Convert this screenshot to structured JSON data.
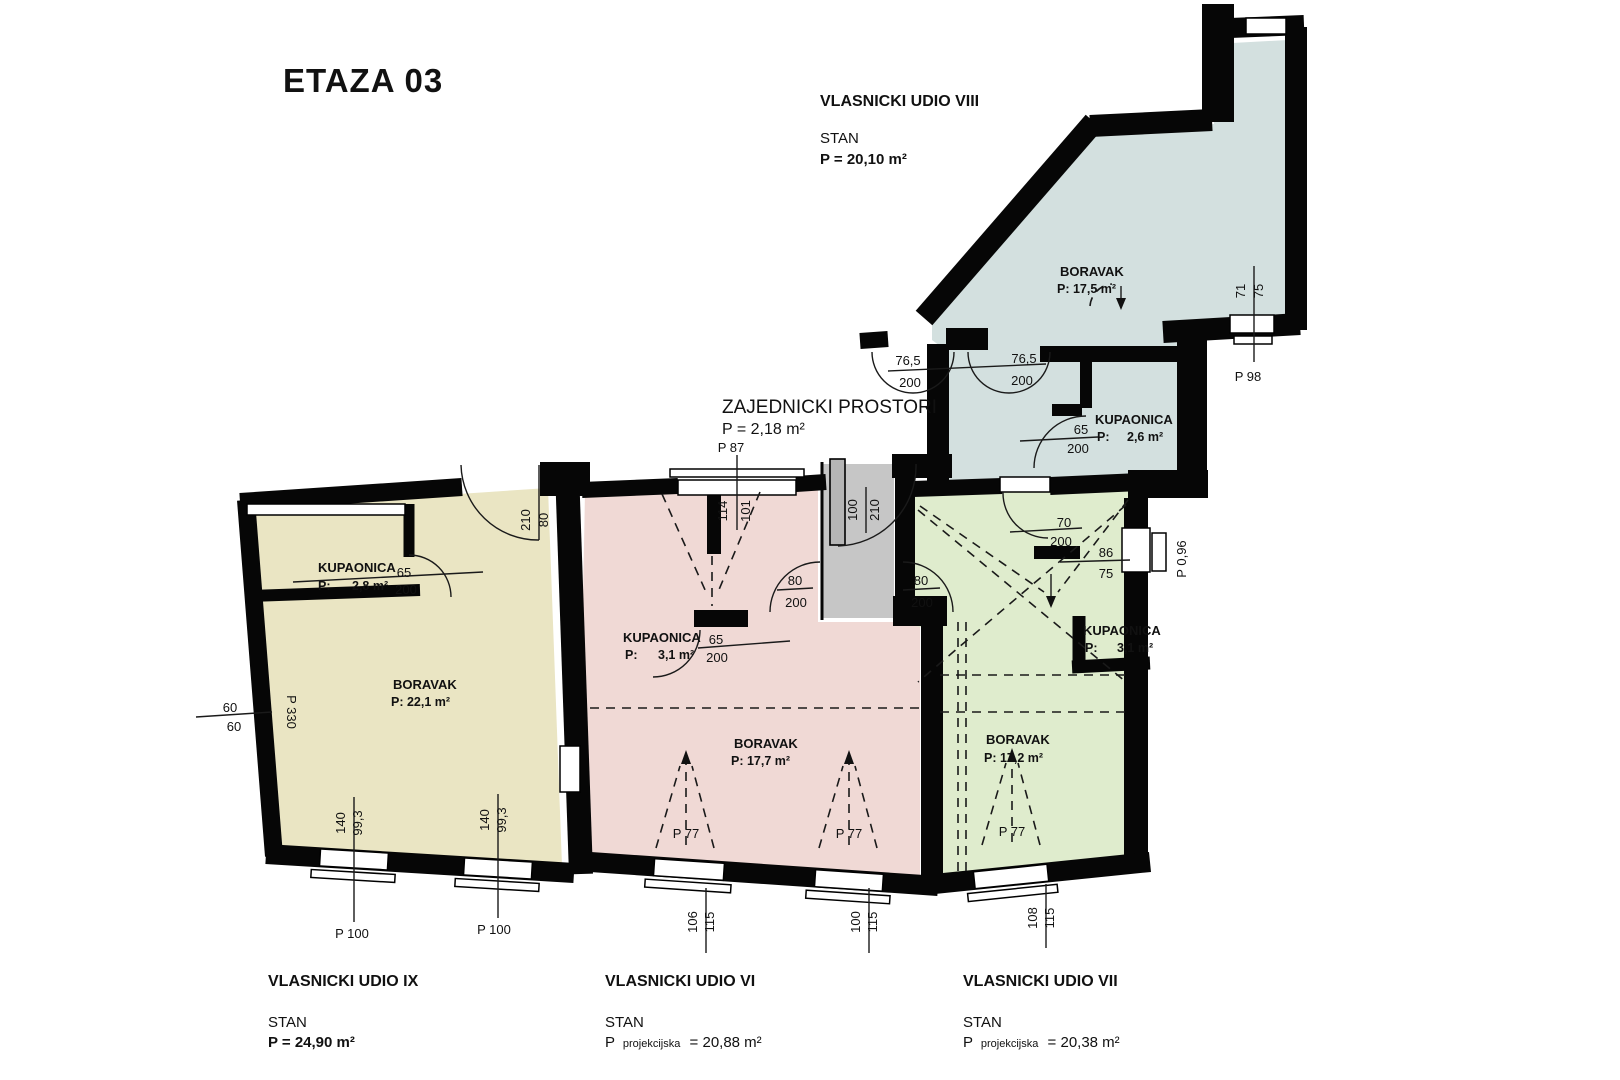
{
  "title": "ETAZA 03",
  "colors": {
    "unit_viii": "#d3e0df",
    "unit_ix": "#eae5c3",
    "unit_vi": "#f0d9d5",
    "unit_vii": "#dfeccd",
    "corridor": "#c6c6c6",
    "door_leaf": "#b5b5b5",
    "wall": "#060606"
  },
  "common_area": {
    "name": "ZAJEDNICKI PROSTORI",
    "area": "P = 2,18 m²"
  },
  "units": {
    "viii": {
      "title": "VLASNICKI UDIO VIII",
      "type": "STAN",
      "area": "P = 20,10 m²",
      "boravak": {
        "name": "BORAVAK",
        "area": "P: 17,5 m²"
      },
      "kupaonica": {
        "name": "KUPAONICA",
        "p": "P:",
        "value": "2,6 m²"
      }
    },
    "ix": {
      "title": "VLASNICKI UDIO IX",
      "type": "STAN",
      "area": "P = 24,90 m²",
      "boravak": {
        "name": "BORAVAK",
        "area": "P: 22,1 m²"
      },
      "kupaonica": {
        "name": "KUPAONICA",
        "p": "P:",
        "value": "2,8 m²"
      }
    },
    "vi": {
      "title": "VLASNICKI UDIO VI",
      "type": "STAN",
      "p": "P",
      "p_sub": "projekcijska",
      "p_value": "= 20,88 m²",
      "boravak": {
        "name": "BORAVAK",
        "area": "P: 17,7 m²"
      },
      "kupaonica": {
        "name": "KUPAONICA",
        "p": "P:",
        "value": "3,1 m²"
      }
    },
    "vii": {
      "title": "VLASNICKI UDIO VII",
      "type": "STAN",
      "p": "P",
      "p_sub": "projekcijska",
      "p_value": "= 20,38 m²",
      "boravak": {
        "name": "BORAVAK",
        "area": "P: 17,2 m²"
      },
      "kupaonica": {
        "name": "KUPAONICA",
        "p": "P:",
        "value": "3,1 m²"
      }
    }
  },
  "dims": {
    "entry_left_w": "76,5",
    "entry_left_h": "200",
    "entry_right_w": "76,5",
    "entry_right_h": "200",
    "corridor_door_w": "100",
    "corridor_door_h": "210",
    "pink_door_w": "80",
    "pink_door_h": "200",
    "green_door_w": "80",
    "green_door_h": "200",
    "blue_kup_door_w": "65",
    "blue_kup_door_h": "200",
    "yellow_kup_door_w": "65",
    "yellow_kup_door_h": "200",
    "pink_kup_door_w": "65",
    "pink_kup_door_h": "200",
    "green_kup_door_w": "70",
    "green_kup_door_h": "200",
    "yellow_door_w": "80",
    "yellow_door_h": "210",
    "top_win_p": "P 87",
    "top_win_a": "114",
    "top_win_b": "101",
    "left_a": "60",
    "left_b": "60",
    "left_p": "P 330",
    "yellow_win1_a": "140",
    "yellow_win1_b": "99,3",
    "yellow_win1_p": "P 100",
    "yellow_win2_a": "140",
    "yellow_win2_b": "99,3",
    "yellow_win2_p": "P 100",
    "pink_roof1": "P 77",
    "pink_roof2": "P 77",
    "green_roof": "P 77",
    "pink_win1_a": "106",
    "pink_win1_b": "115",
    "pink_win2_a": "100",
    "pink_win2_b": "115",
    "green_win1_a": "108",
    "green_win1_b": "115",
    "green_right_a": "86",
    "green_right_b": "75",
    "green_right_p": "P 0,96",
    "blue_win_a": "71",
    "blue_win_b": "75",
    "blue_win_p": "P 98"
  }
}
